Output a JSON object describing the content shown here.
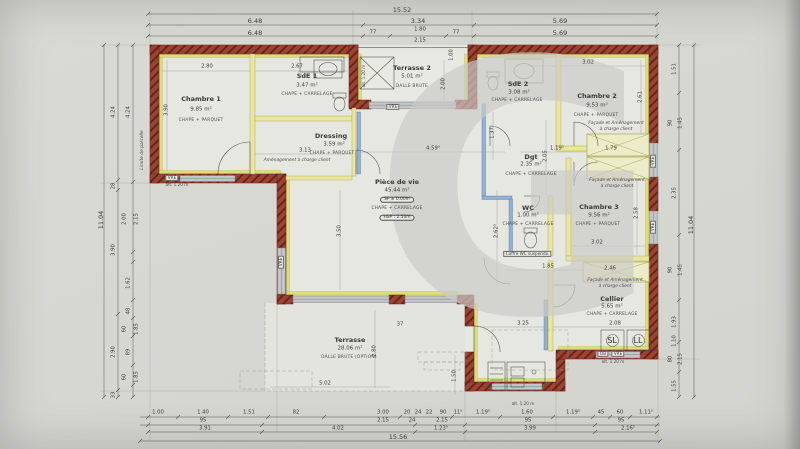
{
  "watermark": "G",
  "rooms": [
    {
      "name": "Chambre 1",
      "area": "9.85 m²",
      "finish": "CHAPE + PARQUET"
    },
    {
      "name": "SdE 1",
      "area": "3.47 m²",
      "finish": "CHAPE + CARRELAGE"
    },
    {
      "name": "Dressing",
      "area": "3.59 m²",
      "finish": "CHAPE + PARQUET"
    },
    {
      "name": "Terrasse 2",
      "area": "5.01 m²",
      "finish": "DALLE BRUTE"
    },
    {
      "name": "SdE 2",
      "area": "3.08 m²",
      "finish": "CHAPE + CARRELAGE"
    },
    {
      "name": "Chambre 2",
      "area": "9.53 m²",
      "finish": "CHAPE + PARQUET"
    },
    {
      "name": "Dgt",
      "area": "2.35 m²",
      "finish": "CHAPE + CARRELAGE"
    },
    {
      "name": "Pièce de vie",
      "area": "45.44 m²",
      "level": "SF ± 0.00m",
      "finish": "CHAPE + CARRELAGE",
      "hsp": "HSP : 2.50m"
    },
    {
      "name": "WC",
      "area": "1.00 m²",
      "finish": "CHAPE + CARRELAGE"
    },
    {
      "name": "Chambre 3",
      "area": "9.56 m²",
      "finish": "CHAPE + PARQUET"
    },
    {
      "name": "Cellier",
      "area": "5.65 m²",
      "finish": "CHAPE + CARRELAGE"
    },
    {
      "name": "Terrasse",
      "area": "28.06 m²",
      "finish": "DALLE BRUTE (OPTION)"
    }
  ],
  "notes": {
    "amenagement": "Aménagement à charge client",
    "facade_l1": "Façade et Aménagement",
    "facade_l2": "à charge client",
    "limite": "Limite de parcelle",
    "coffre_wc": "Coffre WC suspendu"
  },
  "labels": {
    "vre": "VRE",
    "ob": "OB",
    "alt120": "alt. 1.20 m",
    "sl": "SL",
    "ll": "LL"
  },
  "dims": {
    "top": {
      "total": "15.52",
      "row2": [
        "6.48",
        "3.34",
        "5.69"
      ],
      "row3": [
        "6.48",
        "77",
        "1.80",
        "2.15",
        "77",
        "5.69"
      ]
    },
    "bottom": {
      "rowA": [
        "1.00",
        "1.40",
        "1.51",
        "82",
        "3.00",
        "20",
        "24",
        "22",
        "90",
        "11⁵",
        "1.19⁵",
        "1.60",
        "1.19⁵",
        "45",
        "60",
        "1.11⁵"
      ],
      "rowB": [
        "95",
        "2.15",
        "24",
        "2.15",
        "95",
        "95"
      ],
      "rowC": [
        "3.91",
        "4.02",
        "1.23⁵",
        "3.99",
        "2.16⁵"
      ],
      "total": "15.56"
    },
    "left": {
      "total": "11.04",
      "mid": [
        "4.24",
        "28",
        "3.90",
        "2.90",
        "33"
      ],
      "inner": [
        "4.24",
        "2.00",
        "2.15",
        "1.62",
        "48",
        "60",
        "1.85",
        "89",
        "60",
        "1.85"
      ]
    },
    "right": {
      "total": "11.04",
      "inner": [
        "1.51",
        "90",
        "1.45",
        "2.35",
        "90",
        "1.45",
        "1.93",
        "80",
        "2.15",
        "1.55",
        "1.10"
      ]
    },
    "interior": [
      "2.80",
      "2.67",
      "3.02",
      "3.90",
      "2.00",
      "2.61",
      "3.13",
      "4.59⁵",
      "1.19⁵",
      "1.79",
      "2.05",
      "3.50",
      "2.62⁵",
      "1.37",
      "3.02",
      "2.58",
      "1.85",
      "2.46",
      "3.25",
      "2.08",
      "5.02",
      "2.80",
      "1.50",
      "37",
      "1.00"
    ]
  },
  "colors": {
    "wall": "#9a4434",
    "hatch": "#6b2417",
    "insulation": "#d9db70",
    "partition": "#e9e6a0",
    "plumbing": "#8fb2d6",
    "paper": "#d7d7d2",
    "watermark": "#cbcbc7"
  }
}
